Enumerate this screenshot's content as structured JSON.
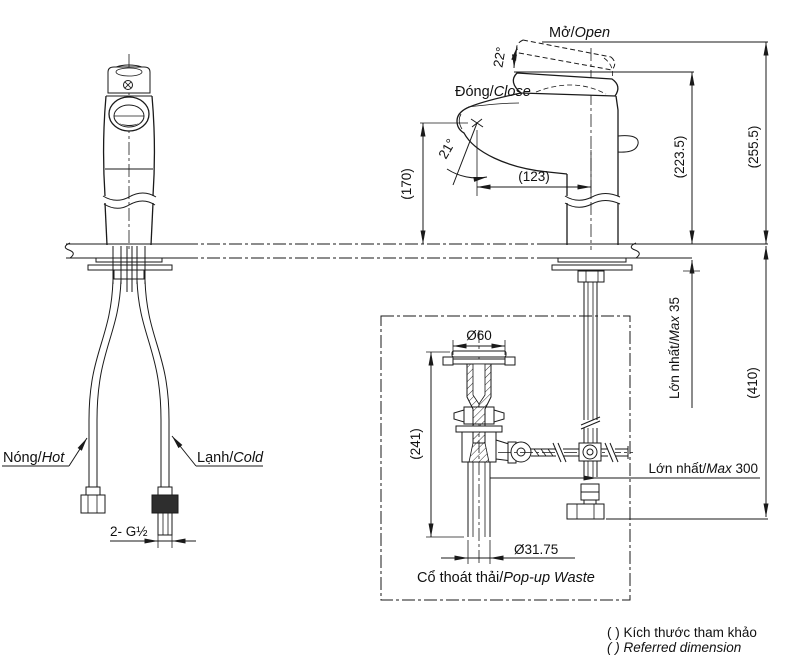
{
  "diagram": {
    "kind": "faucet-installation-technical-drawing",
    "colors": {
      "line": "#1a1a1a",
      "background": "#ffffff"
    },
    "labels": {
      "open": {
        "vi": "Mở/",
        "en": "Open"
      },
      "close": {
        "vi": "Đóng/",
        "en": "Close"
      },
      "hot": {
        "vi": "Nóng/",
        "en": "Hot"
      },
      "cold": {
        "vi": "Lạnh/",
        "en": "Cold"
      },
      "popup": {
        "vi": "Cổ thoát thải/",
        "en": "Pop-up Waste"
      },
      "max35": {
        "vi": "Lớn nhất/",
        "en": "Max",
        "num": " 35"
      },
      "max300": {
        "vi": "Lớn nhất/",
        "en": "Max",
        "num": " 300"
      },
      "thread": "2- G½"
    },
    "dimensions": {
      "angle_open": "22°",
      "angle_spout": "21°",
      "spout_height": "(170)",
      "spout_reach": "(123)",
      "height_closed": "(223.5)",
      "height_open": "(255.5)",
      "below_counter": "(410)",
      "flange_dia": "Ø60",
      "drain_length": "(241)",
      "pipe_dia": "Ø31.75"
    },
    "notes": {
      "vi": "(  ) Kích thước tham khảo",
      "en": "(  ) Referred dimension"
    }
  }
}
